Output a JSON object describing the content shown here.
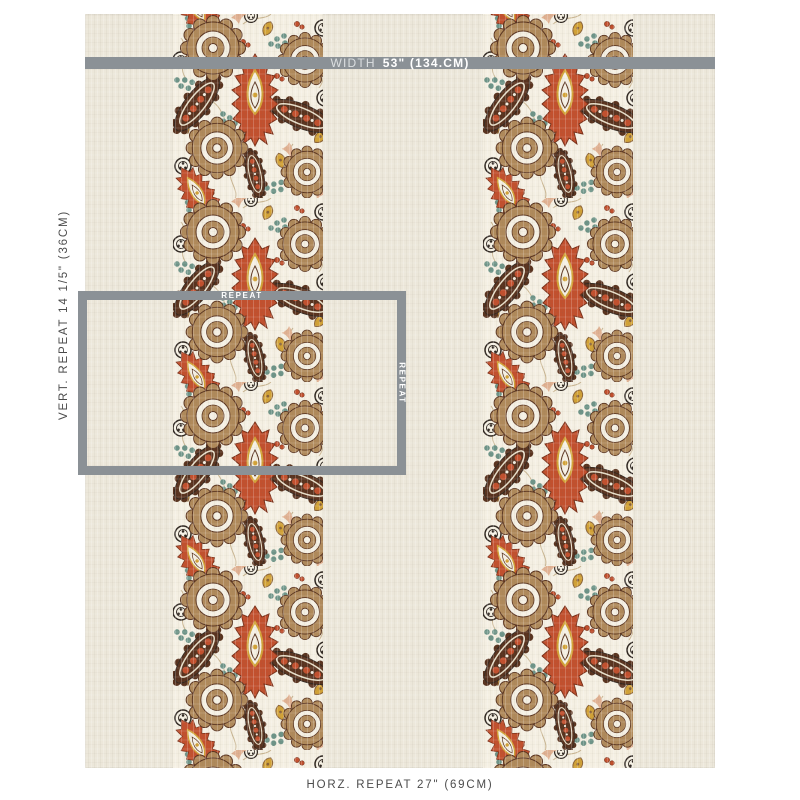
{
  "measurements": {
    "width_label": "WIDTH",
    "width_value": "53\" (134.CM)",
    "vertical_repeat_label": "VERT. REPEAT 14 1/5\" (36CM)",
    "horizontal_repeat_label": "HORZ. REPEAT 27\" (69CM)",
    "repeat_box_top_label": "REPEAT",
    "repeat_box_right_label": "REPEAT",
    "annotation_gray": "#8B9196",
    "caption_text_color": "#4C4C4C"
  },
  "fabric": {
    "description": "cream linen with two vertical paisley floral stripes",
    "background": "#ECE7DA",
    "stripe_count": 2,
    "colors": {
      "cream": "#F4EFE2",
      "rust": "#C2502E",
      "tan": "#B08A5B",
      "darkBrown": "#59331F",
      "teal": "#6E9488",
      "gold": "#D2A237",
      "ink": "#2E2620",
      "salmon": "#E0B192",
      "vine": "#C9B591"
    }
  }
}
